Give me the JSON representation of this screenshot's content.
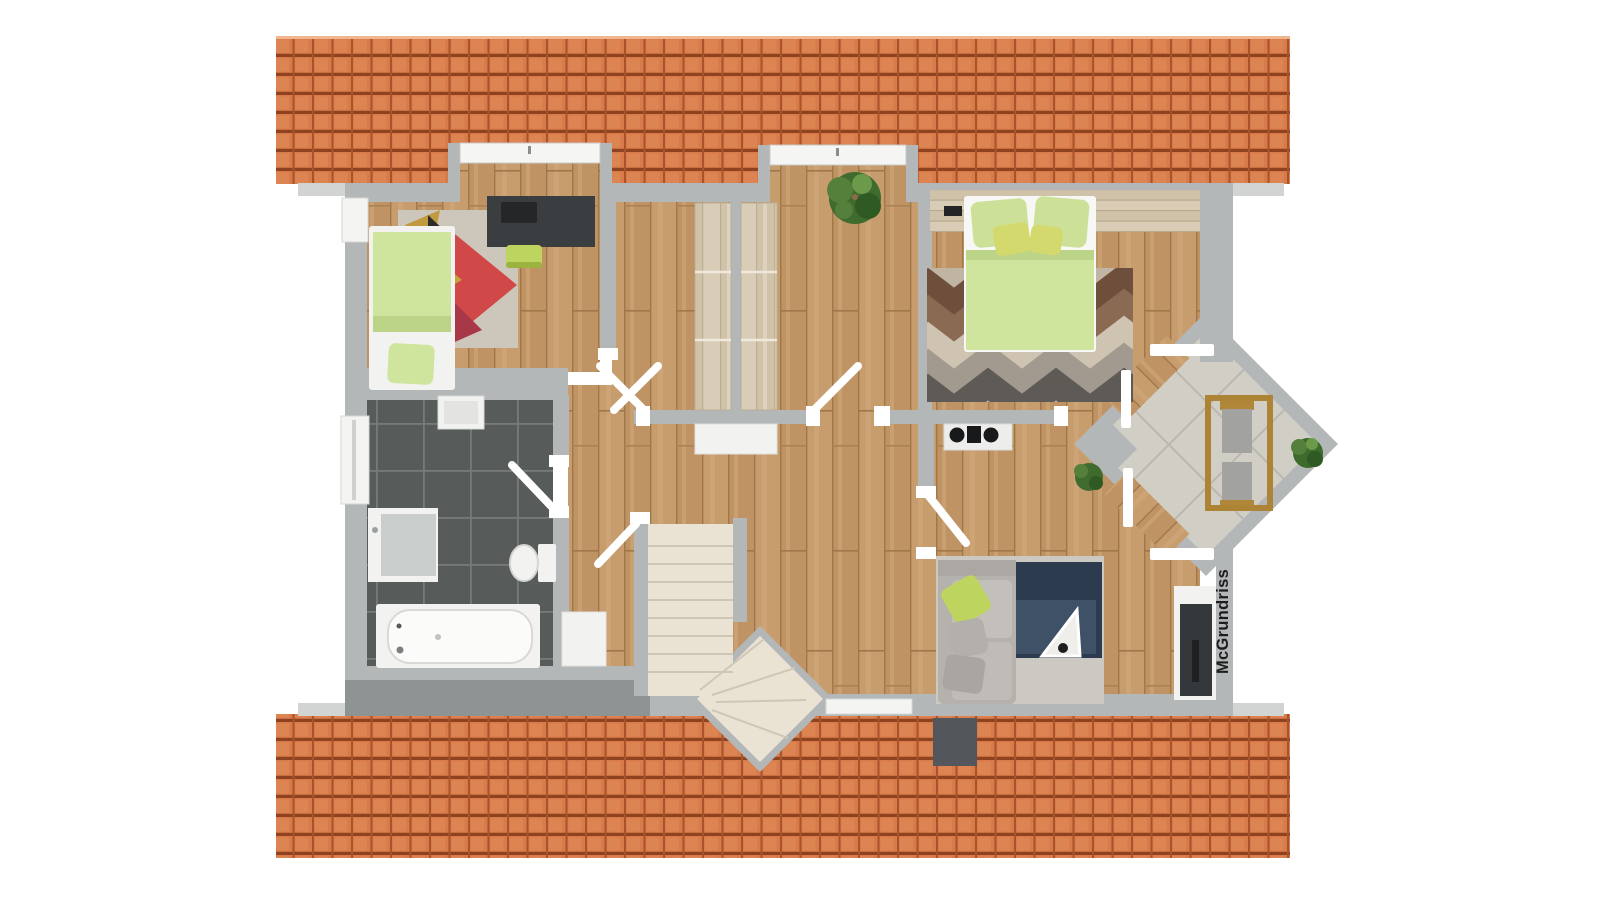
{
  "watermark": {
    "text": "McGrundriss"
  },
  "palette": {
    "page_bg": "#ffffff",
    "wall": "#b4b7b8",
    "wall_dark": "#8e9394",
    "eave": "#d2d4d4",
    "roof": "#d97a4a",
    "roof_line": "#8f4220",
    "wood": "#c79d6e",
    "pale_wood": "#d9cdb7",
    "bath_tile": "#575c5a",
    "terrace_tile": "#d1cec6",
    "stair": "#eae3d3",
    "green_bedding": "#cfe49c",
    "lime": "#bdd45e",
    "navy_rug": "#2c3b4e",
    "sofa_gray": "#b5b1ac",
    "dark_furniture": "#3b3e41",
    "fixture_white": "#f2f2f0",
    "plant_green": "#4a7736",
    "rug_red": "#d04848",
    "watermark_text": "#1d1d1d"
  },
  "semantics": {
    "rooms": [
      "kids-room",
      "center-room",
      "bedroom",
      "bathroom",
      "hallway",
      "living-area",
      "staircase",
      "terrace"
    ],
    "furniture": [
      "single-bed",
      "desk",
      "desk-chair",
      "colorful-rug",
      "wardrobes",
      "double-bed",
      "chevron-rug",
      "kitchenette-cooktop",
      "sofa",
      "floor-lamp",
      "tv-sideboard",
      "bathtub",
      "toilet",
      "shower-unit",
      "terrace-dining-set",
      "plants"
    ]
  }
}
